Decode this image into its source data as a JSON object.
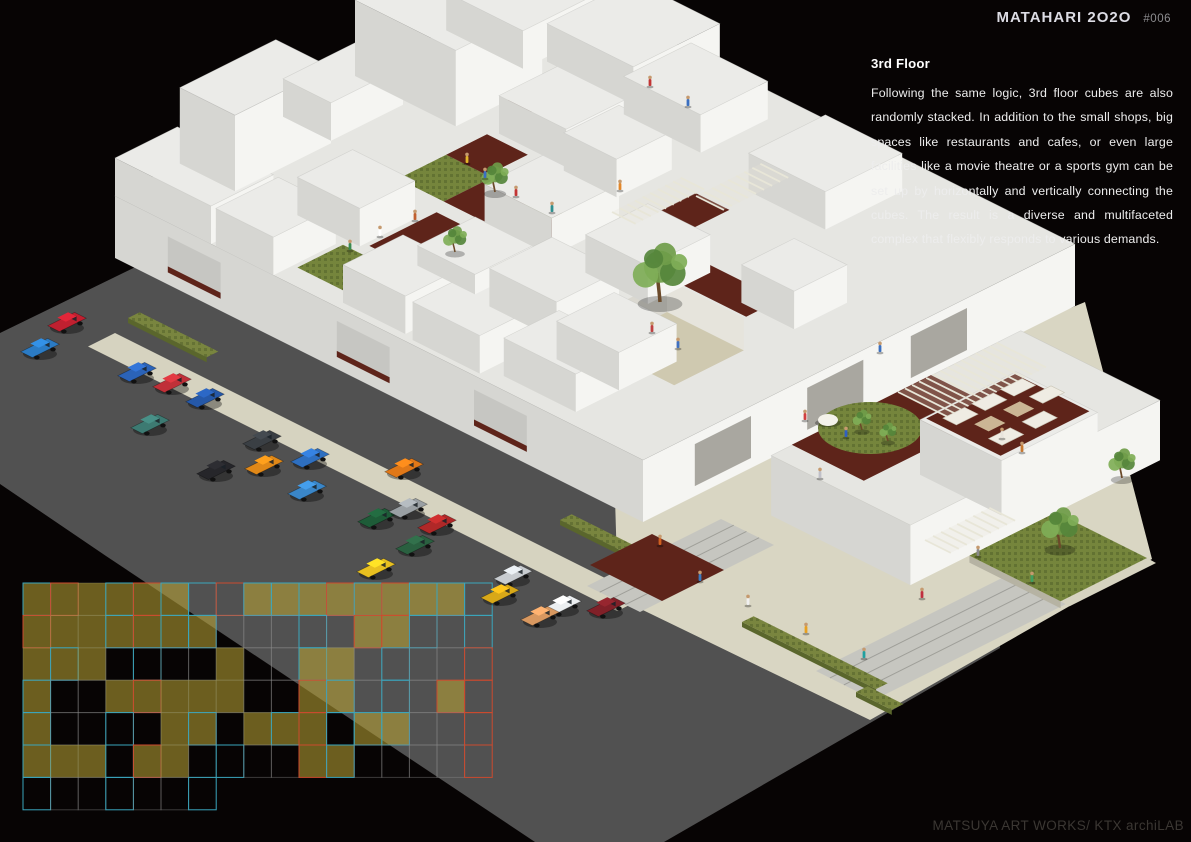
{
  "header": {
    "title": "MATAHARI 2O2O",
    "issue": "#006"
  },
  "description": {
    "heading": "3rd Floor",
    "body": "Following the same logic, 3rd floor cubes are also randomly stacked. In addition to the small shops, big spaces like restaurants and cafes, or even large facilities like a movie theatre or a sports gym can be set up by horizontally and vertically connecting the cubes. The result is a diverse and multifaceted complex that flexibly responds to various demands."
  },
  "credit": {
    "text": "MATSUYA ART WORKS/ KTX archiLAB"
  },
  "palette": {
    "background": "#070404",
    "street": "#515151",
    "apron": "#d9d6c3",
    "hedge": "#79853f",
    "hedge_dark": "#5a662c",
    "walk": "#d6d3c0",
    "roof": "#ebebe8",
    "roof_base": "#e6e6e2",
    "wall_lit": "#f5f5f2",
    "wall_shade": "#d6d6d2",
    "corridor": "#5e241a",
    "lawn": "#75853c",
    "court_floor": "#cfc9b0",
    "crosswalk": "#c6c6c0",
    "crosswalk_line": "#9f9f99",
    "grid_fill": "#b7a133",
    "grid_cyan": "#3aa6bd",
    "grid_red": "#cc4a2e",
    "tree_trunk": "#6b4a2a",
    "tree_leaf_1": "#6f9c49",
    "tree_leaf_2": "#55863b",
    "tree_leaf_3": "#7fae57",
    "skin": "#c59a6f",
    "glass": "#a9a7a0",
    "deck_dome": "#f4f2ea"
  },
  "scene": {
    "street_poly": [
      [
        0,
        333
      ],
      [
        560,
        60
      ],
      [
        985,
        298
      ],
      [
        1000,
        648
      ],
      [
        664,
        842
      ],
      [
        535,
        842
      ],
      [
        106,
        556
      ],
      [
        0,
        484
      ]
    ],
    "apron_poly": [
      [
        615,
        498
      ],
      [
        1085,
        302
      ],
      [
        1152,
        559
      ],
      [
        870,
        720
      ],
      [
        618,
        598
      ]
    ],
    "walks": [
      [
        115,
        333,
        592,
        30
      ]
    ],
    "hedges": [
      [
        128,
        318,
        88
      ],
      [
        560,
        520,
        100
      ],
      [
        742,
        622,
        150
      ],
      [
        856,
        692,
        40
      ]
    ],
    "crosswalks": [
      [
        [
          640,
          612
        ],
        [
          774,
          545
        ],
        [
          721,
          519
        ],
        [
          587,
          586
        ]
      ],
      [
        [
          874,
          700
        ],
        [
          1066,
          604
        ],
        [
          1008,
          575
        ],
        [
          816,
          671
        ]
      ]
    ],
    "ground_patio": [
      [
        590,
        565
      ],
      [
        652,
        534
      ],
      [
        724,
        570
      ],
      [
        662,
        601
      ]
    ],
    "lawn_square": {
      "a": 15.1,
      "b": 2.7,
      "ua": 1.9,
      "ub": 1.8
    },
    "base": {
      "a": 0,
      "b": 0,
      "ua": 11,
      "ub": 9.0,
      "h": 62
    },
    "cubes": [
      [
        0,
        0,
        2.0,
        1.3,
        38
      ],
      [
        0,
        1.35,
        1.15,
        2.0,
        76
      ],
      [
        0.1,
        3.4,
        1.0,
        1.5,
        38
      ],
      [
        0,
        5.0,
        2.1,
        1.8,
        76
      ],
      [
        0,
        6.9,
        1.6,
        2.2,
        38
      ],
      [
        1.7,
        7.3,
        1.8,
        1.8,
        38
      ],
      [
        2.1,
        0,
        1.2,
        1.3,
        38
      ],
      [
        2.3,
        1.5,
        1.3,
        1.15,
        38
      ],
      [
        2.7,
        5.3,
        1.4,
        1.5,
        38
      ],
      [
        3.6,
        7.0,
        1.6,
        1.4,
        38
      ],
      [
        4.6,
        0.15,
        1.3,
        1.25,
        38
      ],
      [
        4.6,
        1.7,
        1.2,
        1.2,
        20
      ],
      [
        4.4,
        3.3,
        1.4,
        1.4,
        38
      ],
      [
        4.15,
        5.2,
        1.1,
        1.15,
        38
      ],
      [
        6.5,
        6.7,
        1.6,
        1.6,
        38
      ],
      [
        6.1,
        0.1,
        1.4,
        1.2,
        38
      ],
      [
        6.2,
        1.6,
        1.4,
        1.3,
        38
      ],
      [
        6.5,
        3.3,
        1.3,
        1.3,
        38
      ],
      [
        7.8,
        0.3,
        1.5,
        1.15,
        38
      ],
      [
        8.0,
        1.2,
        1.3,
        1.2,
        38
      ],
      [
        8.75,
        4.3,
        1.1,
        1.1,
        38
      ]
    ],
    "patches": [
      [
        "lawn",
        2.6,
        3.3,
        0.95,
        1.0
      ],
      [
        "cor",
        3.55,
        3.3,
        0.9,
        1.0
      ],
      [
        "lawn",
        4.45,
        3.3,
        0.6,
        1.0
      ],
      [
        "cor",
        5.05,
        3.3,
        0.75,
        1.0
      ],
      [
        "cor",
        2.6,
        4.3,
        0.85,
        0.85
      ],
      [
        "lawn",
        3.4,
        0.4,
        1.1,
        0.95
      ],
      [
        "cor",
        3.7,
        1.6,
        0.8,
        1.4
      ],
      [
        "cor",
        6.0,
        5.0,
        0.7,
        1.1
      ],
      [
        "cor",
        7.6,
        4.05,
        1.5,
        0.7
      ],
      [
        "cor",
        1.9,
        5.9,
        0.7,
        0.9
      ]
    ],
    "court": {
      "a": 7.5,
      "b": 2.55,
      "ua": 1.6,
      "ub": 1.45,
      "floor": 30
    },
    "wing": {
      "a": 12.2,
      "b": 1.47,
      "ua": 2.9,
      "ub": 5.2,
      "h": 60
    },
    "wing_deck": {
      "a": 12.2,
      "b": 1.9,
      "ua": 1.5,
      "ub": 2.9
    },
    "deck_lawn": {
      "cx": 870,
      "cy": 428,
      "rx": 52,
      "ry": 26
    },
    "deck_dome": {
      "cx": 828,
      "cy": 420,
      "rx": 10,
      "ry": 6
    },
    "restaurant": {
      "a": 12.9,
      "b": 3.87,
      "ua": 1.7,
      "ub": 2.0,
      "h": 55
    },
    "terrace": {
      "a": 12.95,
      "b": 3.95,
      "ua": 1.55,
      "ub": 1.85
    },
    "sofas": [
      [
        13.15,
        4.1
      ],
      [
        13.15,
        4.7
      ],
      [
        13.15,
        5.3
      ],
      [
        14.05,
        4.15
      ],
      [
        14.05,
        4.85
      ],
      [
        13.6,
        5.45
      ]
    ],
    "tables": [
      [
        13.6,
        4.3
      ],
      [
        13.6,
        4.9
      ]
    ],
    "slats": [
      {
        "x": 898,
        "y": 392,
        "la": 1.15,
        "lb": 2.3,
        "n": 14
      },
      {
        "x": 696,
        "y": 196,
        "la": 0.65,
        "lb": 1.5,
        "n": 8
      },
      {
        "x": 612,
        "y": 212,
        "la": 0.55,
        "lb": 1.6,
        "n": 9
      },
      {
        "x": 925,
        "y": 540,
        "la": 0.6,
        "lb": 1.5,
        "n": 8
      }
    ],
    "openings_se": [
      0.12,
      0.38,
      0.62
    ],
    "openings_sw": [
      0.1,
      0.42,
      0.68
    ],
    "trees": [
      {
        "x": 495,
        "y": 192,
        "s": 0.8
      },
      {
        "x": 455,
        "y": 252,
        "s": 0.7
      },
      {
        "x": 660,
        "y": 302,
        "s": 1.6
      },
      {
        "x": 862,
        "y": 430,
        "s": 0.55
      },
      {
        "x": 888,
        "y": 441,
        "s": 0.5
      },
      {
        "x": 1060,
        "y": 548,
        "s": 1.1
      },
      {
        "x": 1122,
        "y": 478,
        "s": 0.8
      }
    ],
    "people": [
      [
        485,
        178,
        "#3a6fc0"
      ],
      [
        516,
        196,
        "#c23434"
      ],
      [
        467,
        163,
        "#e2b62a"
      ],
      [
        552,
        212,
        "#2e8f8f"
      ],
      [
        350,
        250,
        "#3a8a50"
      ],
      [
        415,
        220,
        "#c06030"
      ],
      [
        380,
        236,
        "#ffffff"
      ],
      [
        650,
        86,
        "#c23434"
      ],
      [
        688,
        106,
        "#3a6fc0"
      ],
      [
        620,
        190,
        "#e2872a"
      ],
      [
        652,
        332,
        "#c04040"
      ],
      [
        678,
        348,
        "#4070c0"
      ],
      [
        805,
        420,
        "#d04040"
      ],
      [
        846,
        437,
        "#3060c0"
      ],
      [
        1002,
        438,
        "#e8e4dc"
      ],
      [
        1022,
        452,
        "#c87830"
      ],
      [
        700,
        581,
        "#3a7ac0"
      ],
      [
        748,
        605,
        "#f0f0f0"
      ],
      [
        806,
        633,
        "#e8a020"
      ],
      [
        864,
        658,
        "#20a0a0"
      ],
      [
        922,
        598,
        "#c03040"
      ],
      [
        978,
        556,
        "#8a8a8a"
      ],
      [
        1032,
        582,
        "#40a060"
      ],
      [
        660,
        545,
        "#d06020"
      ],
      [
        820,
        478,
        "#c0c0c8"
      ],
      [
        880,
        352,
        "#3a6fc0"
      ]
    ],
    "cars": [
      [
        40,
        348,
        "#2b7bc4"
      ],
      [
        67,
        322,
        "#c02030"
      ],
      [
        137,
        372,
        "#2b63b8"
      ],
      [
        172,
        383,
        "#c03038"
      ],
      [
        150,
        424,
        "#3d7a72"
      ],
      [
        205,
        398,
        "#2558a8"
      ],
      [
        216,
        470,
        "#26262a"
      ],
      [
        262,
        440,
        "#3a3f44"
      ],
      [
        264,
        465,
        "#e08818"
      ],
      [
        310,
        458,
        "#2e6fc0"
      ],
      [
        307,
        490,
        "#3a86c8"
      ],
      [
        404,
        468,
        "#e07818"
      ],
      [
        377,
        518,
        "#1e5c38"
      ],
      [
        408,
        508,
        "#9aa0a4"
      ],
      [
        437,
        524,
        "#b02828"
      ],
      [
        415,
        545,
        "#2a6040"
      ],
      [
        376,
        568,
        "#e8c020"
      ],
      [
        513,
        575,
        "#c8ccd0"
      ],
      [
        500,
        594,
        "#d8a818"
      ],
      [
        562,
        605,
        "#eceff1"
      ],
      [
        540,
        616,
        "#d89860"
      ],
      [
        606,
        607,
        "#802028"
      ]
    ],
    "plan_grid": {
      "origin": [
        23,
        583
      ],
      "cell_w": 27.6,
      "cell_h": 32.4,
      "rows": [
        "yrfyrycRyyyryryyc",
        "rffyryyeeecerrcec",
        "fyfeceefeeyfeceeR",
        "yeefrfffeeryecerR",
        "yeecefyefyrcyyeeR",
        "yffcrfeceeryeeeeR",
        "ceeceec.........."
      ]
    }
  }
}
